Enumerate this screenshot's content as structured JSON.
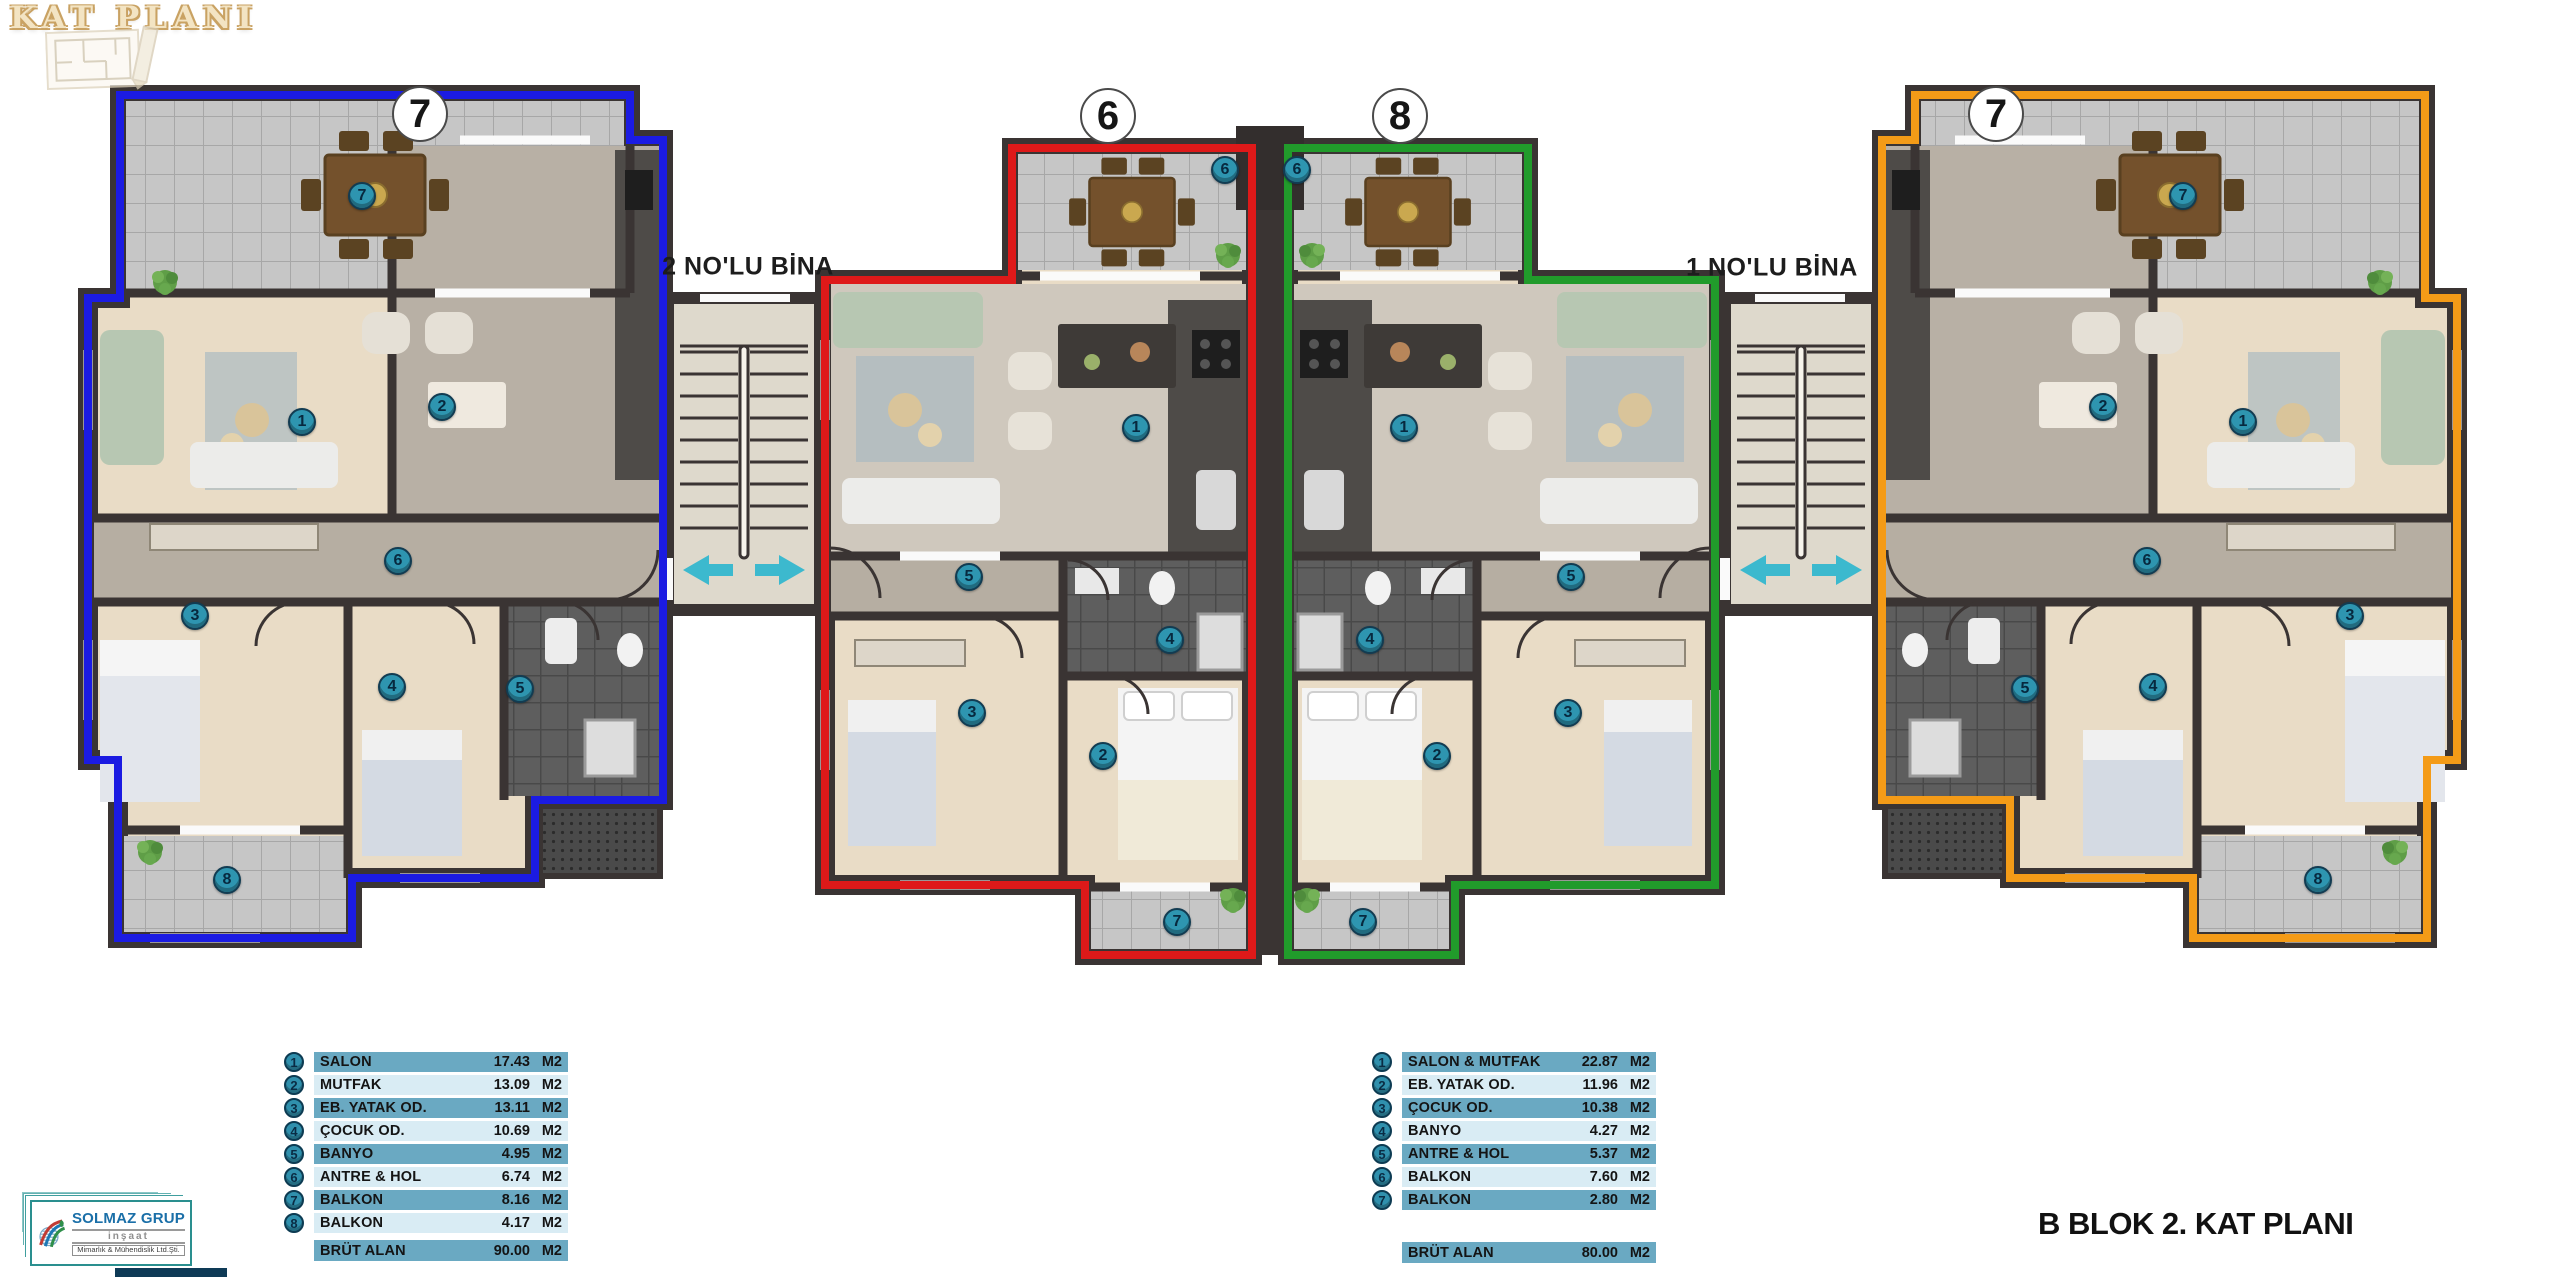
{
  "header": {
    "title": "KAT PLANI"
  },
  "footer": {
    "plan_title": "B BLOK 2. KAT PLANI"
  },
  "buildings": [
    {
      "label": "2 NO'LU BİNA",
      "x": 748,
      "y": 267
    },
    {
      "label": "1 NO'LU BİNA",
      "x": 1772,
      "y": 268
    }
  ],
  "unit_badges": [
    {
      "number": "7",
      "x": 420,
      "y": 114
    },
    {
      "number": "6",
      "x": 1108,
      "y": 116
    },
    {
      "number": "8",
      "x": 1400,
      "y": 116
    },
    {
      "number": "7",
      "x": 1996,
      "y": 114
    }
  ],
  "markers": [
    {
      "unit": "blue",
      "n": "7",
      "x": 362,
      "y": 196
    },
    {
      "unit": "blue",
      "n": "1",
      "x": 302,
      "y": 422
    },
    {
      "unit": "blue",
      "n": "2",
      "x": 442,
      "y": 407
    },
    {
      "unit": "blue",
      "n": "6",
      "x": 398,
      "y": 561
    },
    {
      "unit": "blue",
      "n": "3",
      "x": 195,
      "y": 616
    },
    {
      "unit": "blue",
      "n": "4",
      "x": 392,
      "y": 687
    },
    {
      "unit": "blue",
      "n": "5",
      "x": 520,
      "y": 689
    },
    {
      "unit": "blue",
      "n": "8",
      "x": 227,
      "y": 880
    },
    {
      "unit": "red",
      "n": "6",
      "x": 1225,
      "y": 170
    },
    {
      "unit": "red",
      "n": "1",
      "x": 1136,
      "y": 428
    },
    {
      "unit": "red",
      "n": "5",
      "x": 969,
      "y": 577
    },
    {
      "unit": "red",
      "n": "4",
      "x": 1170,
      "y": 640
    },
    {
      "unit": "red",
      "n": "3",
      "x": 972,
      "y": 713
    },
    {
      "unit": "red",
      "n": "2",
      "x": 1103,
      "y": 756
    },
    {
      "unit": "red",
      "n": "7",
      "x": 1177,
      "y": 922
    },
    {
      "unit": "green",
      "n": "6",
      "x": 1297,
      "y": 170
    },
    {
      "unit": "green",
      "n": "1",
      "x": 1404,
      "y": 428
    },
    {
      "unit": "green",
      "n": "5",
      "x": 1571,
      "y": 577
    },
    {
      "unit": "green",
      "n": "4",
      "x": 1370,
      "y": 640
    },
    {
      "unit": "green",
      "n": "3",
      "x": 1568,
      "y": 713
    },
    {
      "unit": "green",
      "n": "2",
      "x": 1437,
      "y": 756
    },
    {
      "unit": "green",
      "n": "7",
      "x": 1363,
      "y": 922
    },
    {
      "unit": "orange",
      "n": "7",
      "x": 2183,
      "y": 196
    },
    {
      "unit": "orange",
      "n": "1",
      "x": 2243,
      "y": 422
    },
    {
      "unit": "orange",
      "n": "2",
      "x": 2103,
      "y": 407
    },
    {
      "unit": "orange",
      "n": "6",
      "x": 2147,
      "y": 561
    },
    {
      "unit": "orange",
      "n": "3",
      "x": 2350,
      "y": 616
    },
    {
      "unit": "orange",
      "n": "4",
      "x": 2153,
      "y": 687
    },
    {
      "unit": "orange",
      "n": "5",
      "x": 2025,
      "y": 689
    },
    {
      "unit": "orange",
      "n": "8",
      "x": 2318,
      "y": 880
    }
  ],
  "legends": [
    {
      "rows": [
        {
          "num": "1",
          "label": "SALON",
          "value": "17.43",
          "unit": "M2"
        },
        {
          "num": "2",
          "label": "MUTFAK",
          "value": "13.09",
          "unit": "M2"
        },
        {
          "num": "3",
          "label": "EB. YATAK OD.",
          "value": "13.11",
          "unit": "M2"
        },
        {
          "num": "4",
          "label": "ÇOCUK OD.",
          "value": "10.69",
          "unit": "M2"
        },
        {
          "num": "5",
          "label": "BANYO",
          "value": "4.95",
          "unit": "M2"
        },
        {
          "num": "6",
          "label": "ANTRE & HOL",
          "value": "6.74",
          "unit": "M2"
        },
        {
          "num": "7",
          "label": "BALKON",
          "value": "8.16",
          "unit": "M2"
        },
        {
          "num": "8",
          "label": "BALKON",
          "value": "4.17",
          "unit": "M2"
        }
      ],
      "total": {
        "label": "BRÜT ALAN",
        "value": "90.00",
        "unit": "M2"
      }
    },
    {
      "rows": [
        {
          "num": "1",
          "label": "SALON & MUTFAK",
          "value": "22.87",
          "unit": "M2"
        },
        {
          "num": "2",
          "label": "EB. YATAK OD.",
          "value": "11.96",
          "unit": "M2"
        },
        {
          "num": "3",
          "label": "ÇOCUK OD.",
          "value": "10.38",
          "unit": "M2"
        },
        {
          "num": "4",
          "label": "BANYO",
          "value": "4.27",
          "unit": "M2"
        },
        {
          "num": "5",
          "label": "ANTRE & HOL",
          "value": "5.37",
          "unit": "M2"
        },
        {
          "num": "6",
          "label": "BALKON",
          "value": "7.60",
          "unit": "M2"
        },
        {
          "num": "7",
          "label": "BALKON",
          "value": "2.80",
          "unit": "M2"
        }
      ],
      "total": {
        "label": "BRÜT ALAN",
        "value": "80.00",
        "unit": "M2"
      }
    }
  ],
  "logo": {
    "name": "SOLMAZ GRUP",
    "line2": "inşaat",
    "line3": "Mimarlık & Mühendislik Ltd.Şti."
  },
  "accent_colors": {
    "unit_blue": "#1b1be2",
    "unit_red": "#de1919",
    "unit_green": "#219b2b",
    "unit_orange": "#f49b17",
    "legend_row_dark": "#6aa9c2",
    "legend_row_light": "#d9ecf4",
    "room_marker": "#2e95b0",
    "entrance_arrow": "#3cb9ce"
  }
}
